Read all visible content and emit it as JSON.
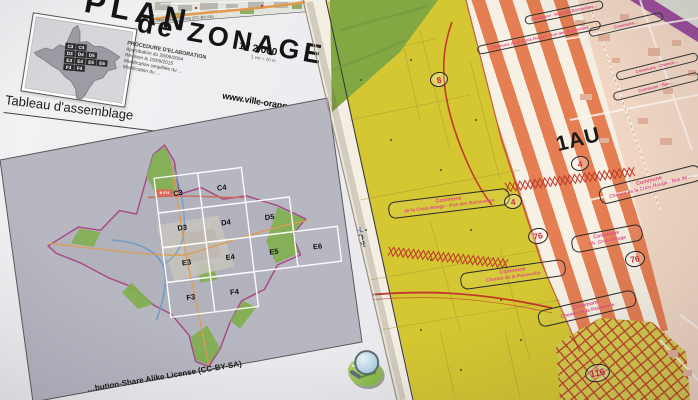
{
  "left_page": {
    "title_line1": "PLAN",
    "title_line2": "de ZONAGE",
    "scale": "1 / 2 000",
    "scale_note": "1 cm = 20 m",
    "procedure_heading": "PROCEDURE D'ELABORATION",
    "procedure_lines": [
      "Approbation du 29/06/2004",
      "Révision le 15/09/2015",
      "Modification simplifiée du …",
      "Modification du …"
    ],
    "website": "www.ville-orange.fr",
    "assemblage_title": "Tableau d'assemblage",
    "road_badge": "N 974",
    "grid_cells": [
      "C3",
      "C4",
      "D3",
      "D4",
      "D5",
      "E3",
      "E4",
      "E5",
      "E6",
      "F3",
      "F4"
    ],
    "inset_caption": "…Share Alike License (CC-BY-SA)",
    "license_caption": "…bution-Share Alike License (CC-BY-SA)"
  },
  "zoning_map": {
    "zone_label": "1AU",
    "sheet_ref": "C2'",
    "coordinate": "4 890 000",
    "circled_numbers": [
      "8",
      "4",
      "4",
      "76",
      "76",
      "116"
    ],
    "labels": [
      {
        "line1": "Commune",
        "line2": "de la Croix-Rouge - Rue des Bartavelles"
      },
      {
        "line1": "Commune",
        "line2": "Chemin de la Croix-Rouge - Rue de…"
      },
      {
        "line1": "Commune",
        "line2": "Ch. Croix-Rouge"
      },
      {
        "line1": "Commune",
        "line2": "Chemin de la Passerelle"
      },
      {
        "line1": "Commune",
        "line2": "Chemin de la Passerelle"
      }
    ],
    "small_labels": [
      "Commune · Rue des Bartavelles…",
      "Commune…",
      "Commune de la Croix-Rouge - Rue des Bartavelles",
      "Commune · Chemin…",
      "Commune · Rue…"
    ]
  },
  "colors": {
    "zone_yellow": "#d5c731",
    "zone_stripe_orange": "#e57e52",
    "zone_pink": "#f2d8c4",
    "zone_green": "#82a844",
    "hatch_red": "#bf3b28",
    "label_pink": "#e24a85",
    "circle_red": "#c72f3d",
    "purple_edge": "#9b4d9b"
  }
}
